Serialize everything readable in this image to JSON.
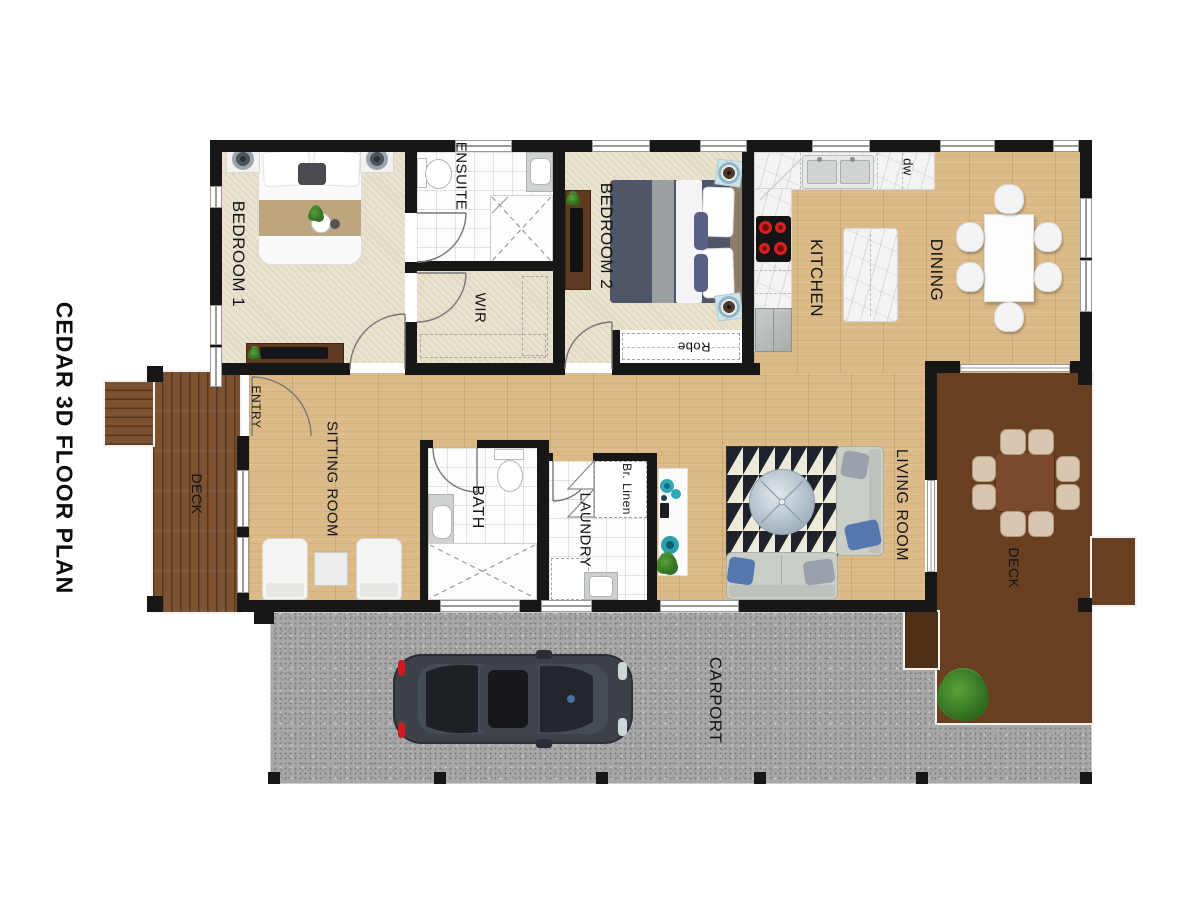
{
  "title": "CEDAR 3D FLOOR PLAN",
  "labels": {
    "bedroom1": "BEDROOM 1",
    "ensuite": "ENSUITE",
    "wir": "WIR",
    "bedroom2": "BEDROOM 2",
    "robe": "Robe",
    "kitchen": "KITCHEN",
    "dining": "DINING",
    "dw": "dw",
    "entry": "ENTRY",
    "deck_left": "DECK",
    "sitting_room": "SITTING ROOM",
    "bath": "BATH",
    "laundry": "LAUNDRY",
    "br_linen": "Br. Linen",
    "living_room": "LIVING ROOM",
    "deck_right": "DECK",
    "carport": "CARPORT"
  },
  "palette": {
    "wall": "#171717",
    "carpet": "#e9e3cf",
    "timber_floor": "#dcba87",
    "deck_timber": "#7c5231",
    "gravel": "#a8a8a8",
    "marble": "#f3f3f4",
    "rug_dark": "#20222b",
    "accent_teal": "#2fa8b5",
    "burner_red": "#d42323"
  }
}
